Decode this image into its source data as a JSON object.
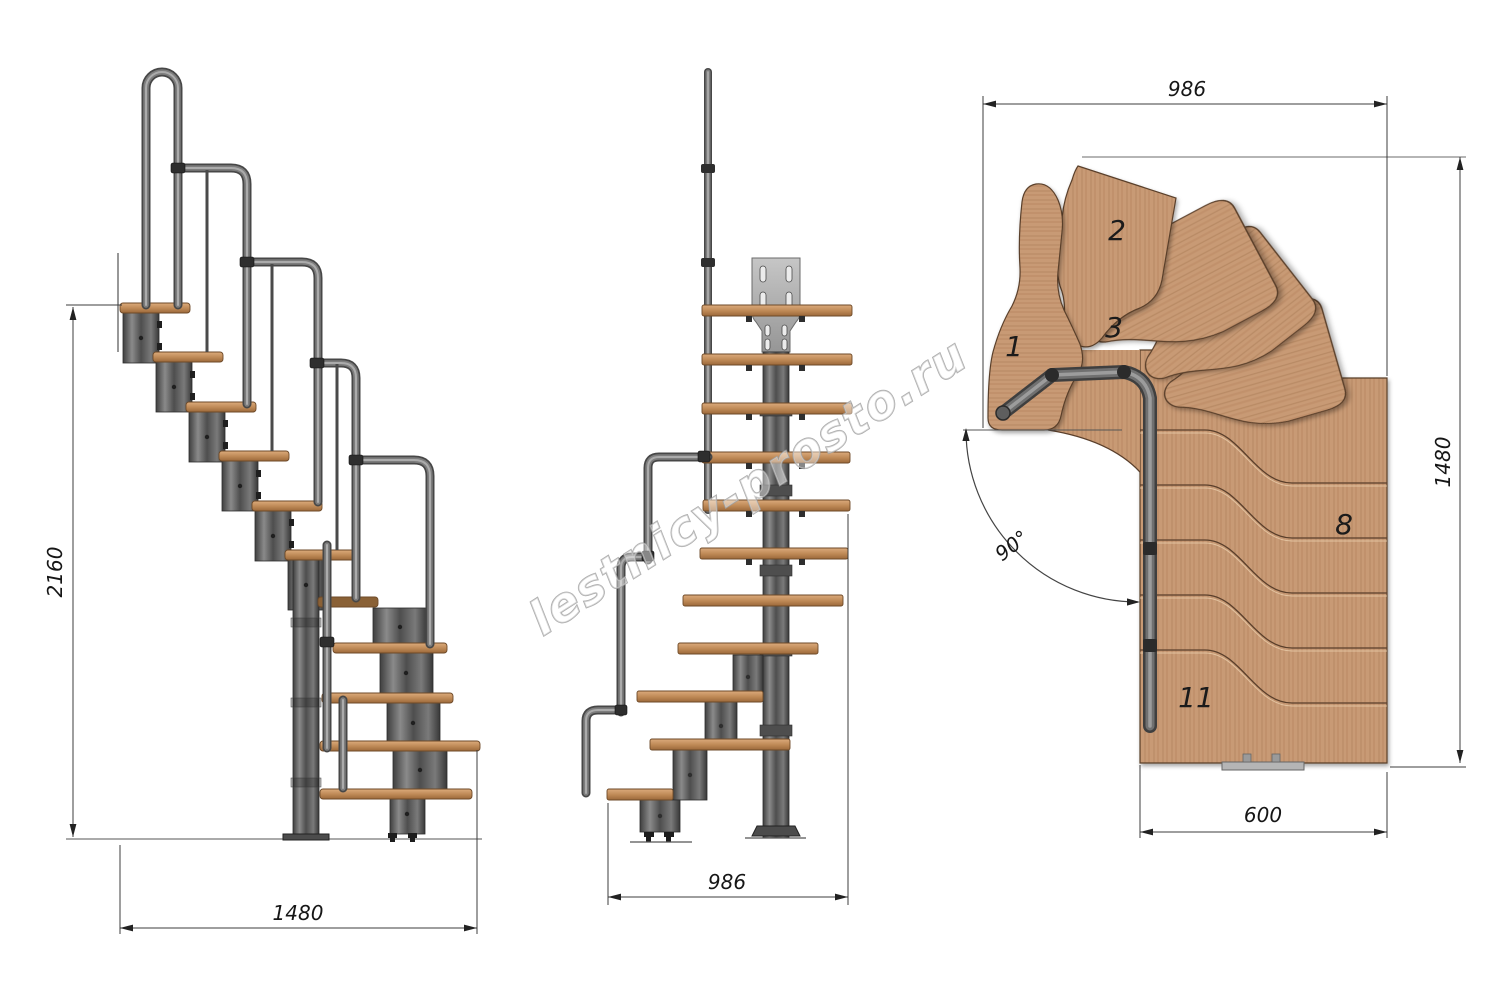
{
  "document": {
    "type": "technical-drawing",
    "subject": "modular L-shaped staircase, three orthographic views",
    "background": "#ffffff"
  },
  "watermark": {
    "text": "lestnicy-prosto.ru"
  },
  "views": {
    "side": {
      "label": "side-elevation",
      "height_dim": "2160",
      "width_dim": "1480"
    },
    "front": {
      "label": "front-elevation",
      "width_dim": "986"
    },
    "plan": {
      "label": "top-plan",
      "top_width_dim": "986",
      "right_height_dim": "1480",
      "bottom_width_dim": "600",
      "turn_angle": "90°",
      "tread_labels": {
        "t1": "1",
        "t2": "2",
        "t3": "3",
        "t8": "8",
        "t11": "11"
      }
    }
  },
  "colors": {
    "wood": "#c89a74",
    "wood_edge": "#5a3f2b",
    "metal": "#5a5a5a",
    "rail": "#6e6e6e",
    "plate": "#b2b2b2",
    "dim_line": "#3c3c3c",
    "text": "#161616",
    "watermark": "#9f9f9f"
  }
}
